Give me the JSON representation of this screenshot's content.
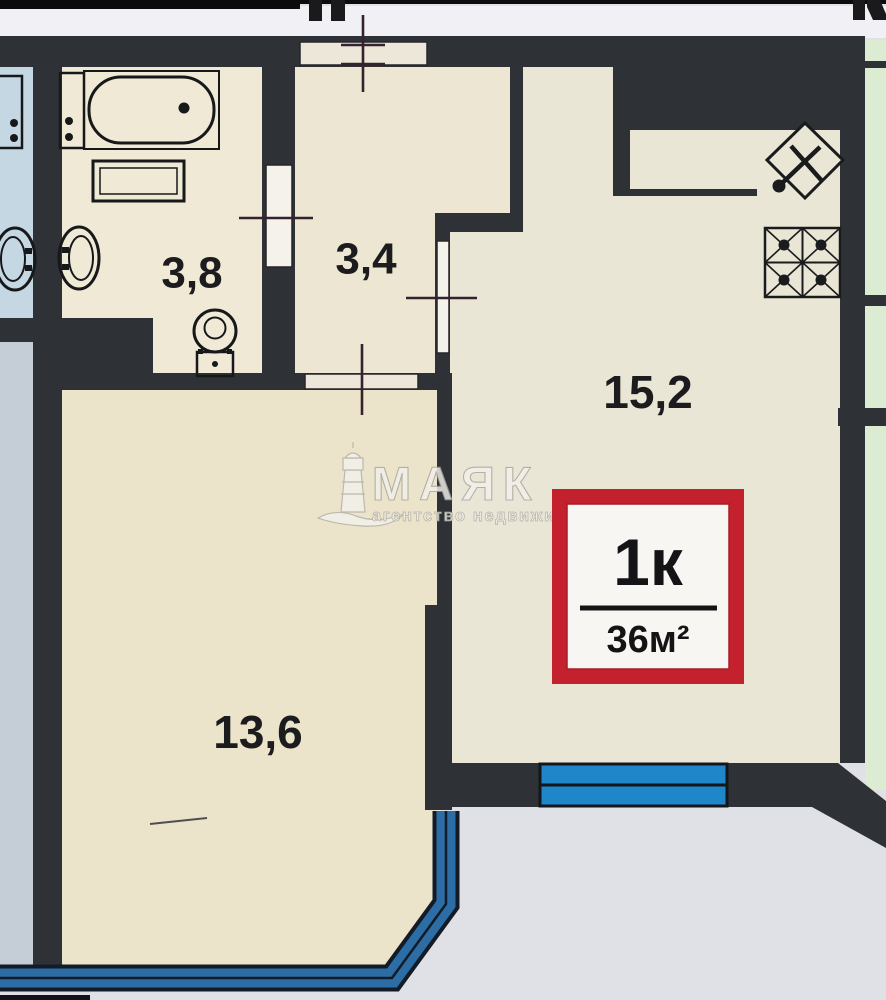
{
  "document": {
    "type": "apartment floor plan (real estate scan)"
  },
  "rooms": [
    {
      "name": "bathroom",
      "area_label": "3,8"
    },
    {
      "name": "hallway",
      "area_label": "3,4"
    },
    {
      "name": "kitchen-living-room",
      "area_label": "15,2"
    },
    {
      "name": "living-room",
      "area_label": "13,6"
    }
  ],
  "badge": {
    "rooms": "1к",
    "area": "36м²"
  },
  "watermark": {
    "brand": "МАЯК",
    "tagline": "агентство недвижимости"
  },
  "colors": {
    "wall": "#2e3237",
    "room_cream": "#ece6d3",
    "neighbor_blue": "#c6d7e4",
    "neighbor_blue_gray": "#c5ced6",
    "neighbor_green": "#dcecd2",
    "window_bright_blue": "#1f86c9",
    "bay_window_blue": "#2d6da5",
    "badge_red": "#c2212d",
    "badge_white": "#f7f6f3",
    "outside": "#dfe1e7",
    "scan_strip": "#f1f0f4",
    "measure_mark": "#35222e"
  }
}
